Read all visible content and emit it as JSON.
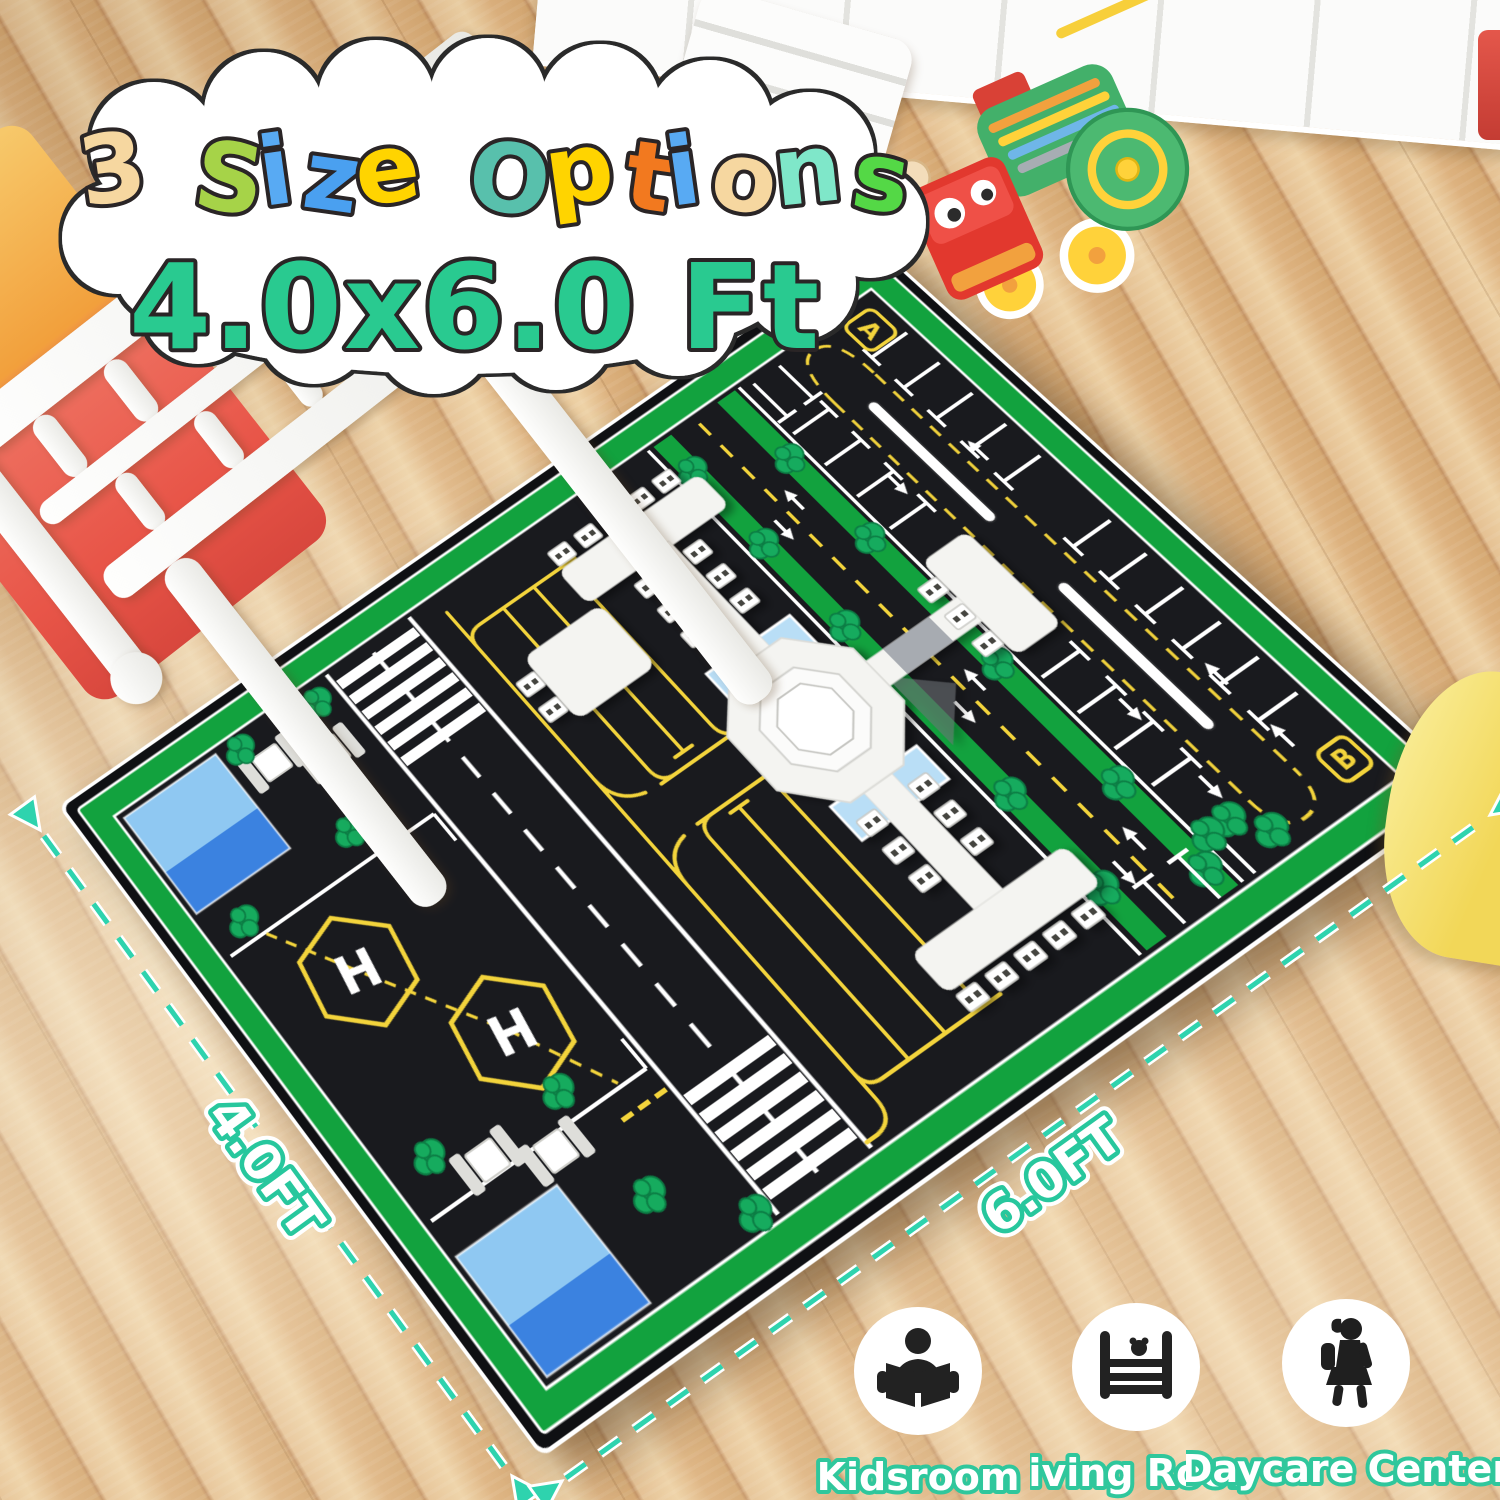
{
  "title": {
    "line1_letters": [
      {
        "ch": "3",
        "color": "#f6d7a0"
      },
      {
        "ch": " ",
        "color": "#ffffff"
      },
      {
        "ch": "S",
        "color": "#a6d348"
      },
      {
        "ch": "i",
        "color": "#58aaf3"
      },
      {
        "ch": "z",
        "color": "#4aa0f0"
      },
      {
        "ch": "e",
        "color": "#ffd400"
      },
      {
        "ch": " ",
        "color": "#ffffff"
      },
      {
        "ch": "O",
        "color": "#58c0ac"
      },
      {
        "ch": "p",
        "color": "#ffd400"
      },
      {
        "ch": "t",
        "color": "#f2791f"
      },
      {
        "ch": "i",
        "color": "#58aaf3"
      },
      {
        "ch": "o",
        "color": "#f6d7a0"
      },
      {
        "ch": "n",
        "color": "#7fe7c9"
      },
      {
        "ch": "s",
        "color": "#54d846"
      }
    ],
    "line2": "4.0x6.0 Ft",
    "line2_color": "#29ca90",
    "outline": "#2a2526"
  },
  "dimensions": {
    "side_label": "4.0FT",
    "front_label": "6.0FT",
    "accent": "#2ed3ae"
  },
  "mat": {
    "marker_a": "A",
    "marker_b": "B",
    "helipad": "H",
    "colors": {
      "asphalt": "#191a1e",
      "edge_black": "#0f1013",
      "border_green": "#12a23e",
      "taxi_yellow": "#f3d43c",
      "line_white": "#ffffff",
      "water_light": "#8fc8f2",
      "water_dark": "#3b82e0",
      "tree_green": "#16ab5e"
    }
  },
  "badges_style": {
    "label_fill": "#ffffff",
    "label_outline": "#2fc79c",
    "label_outline_dark": "#17936e"
  },
  "badges": [
    {
      "icon": "reading-child-icon",
      "label": "Kidsroom"
    },
    {
      "icon": "crib-icon",
      "label": "Living Room"
    },
    {
      "icon": "walking-girl-icon",
      "label": "Daycare Center"
    }
  ]
}
